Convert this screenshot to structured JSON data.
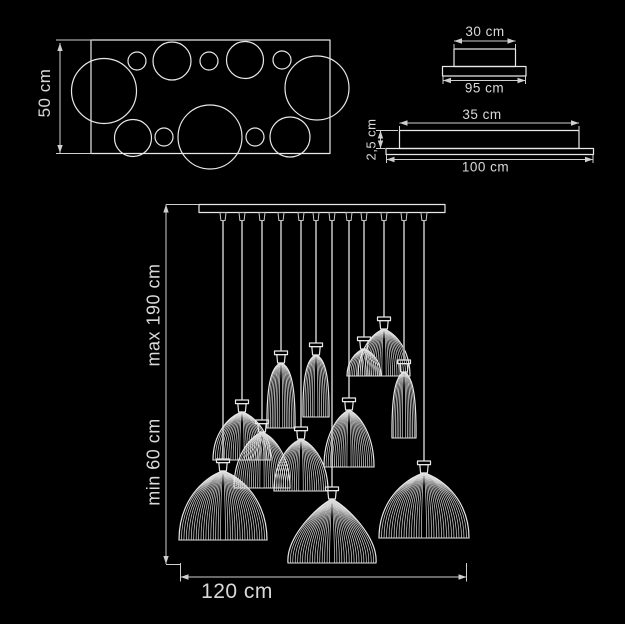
{
  "colors": {
    "background": "#000000",
    "line": "#e8e8e8",
    "rib": "#d9d9d9",
    "dimension": "#cfcfcf",
    "cord": "#a6a6a6",
    "text": "#d9d9d9"
  },
  "top_view": {
    "height_label": "50 cm",
    "frame": {
      "x": 91,
      "y": 40,
      "w": 239,
      "h": 113.5
    },
    "circles": [
      [
        104,
        91,
        32.5
      ],
      [
        137,
        61,
        9
      ],
      [
        172,
        61,
        19
      ],
      [
        209,
        61,
        9
      ],
      [
        245,
        60,
        18.5
      ],
      [
        282,
        60,
        9
      ],
      [
        317,
        88,
        32
      ],
      [
        133,
        138,
        18.5
      ],
      [
        164,
        137,
        9
      ],
      [
        210,
        137,
        32
      ],
      [
        255,
        137,
        9
      ],
      [
        290,
        137,
        20
      ]
    ]
  },
  "canopy_front": {
    "width_top_label": "30 cm",
    "width_bottom_label": "95 cm"
  },
  "canopy_side": {
    "width_top_label": "35 cm",
    "height_label": "2,5 cm",
    "width_bottom_label": "100 cm"
  },
  "fixture": {
    "height_min_label": "min 60 cm",
    "height_max_label": "max 190 cm",
    "width_label": "120 cm",
    "bar": {
      "x": 199,
      "y": 204.5,
      "w": 246,
      "h": 8
    },
    "lamps": [
      {
        "x": 223,
        "cap": 459,
        "top": 471,
        "bottom": 540,
        "hw": 44,
        "shape": "dome"
      },
      {
        "x": 242,
        "cap": 400,
        "top": 412,
        "bottom": 460,
        "hw": 29,
        "shape": "dome"
      },
      {
        "x": 262,
        "cap": 420,
        "top": 432,
        "bottom": 488,
        "hw": 28,
        "shape": "dome"
      },
      {
        "x": 281,
        "cap": 351,
        "top": 363,
        "bottom": 428,
        "hw": 14,
        "shape": "cone"
      },
      {
        "x": 301,
        "cap": 427,
        "top": 439,
        "bottom": 491,
        "hw": 27,
        "shape": "dome"
      },
      {
        "x": 316,
        "cap": 343,
        "top": 355,
        "bottom": 417,
        "hw": 13,
        "shape": "cone"
      },
      {
        "x": 332,
        "cap": 487,
        "top": 499,
        "bottom": 563,
        "hw": 44,
        "shape": "dome2"
      },
      {
        "x": 349,
        "cap": 398,
        "top": 410,
        "bottom": 467,
        "hw": 25,
        "shape": "dome"
      },
      {
        "x": 364,
        "cap": 337,
        "top": 349,
        "bottom": 376,
        "hw": 17,
        "shape": "dome"
      },
      {
        "x": 384,
        "cap": 317,
        "top": 329,
        "bottom": 376,
        "hw": 26,
        "shape": "dome"
      },
      {
        "x": 404,
        "cap": 360,
        "top": 372,
        "bottom": 438,
        "hw": 12,
        "shape": "cone"
      },
      {
        "x": 424,
        "cap": 461,
        "top": 473,
        "bottom": 538,
        "hw": 45,
        "shape": "dome"
      }
    ]
  }
}
